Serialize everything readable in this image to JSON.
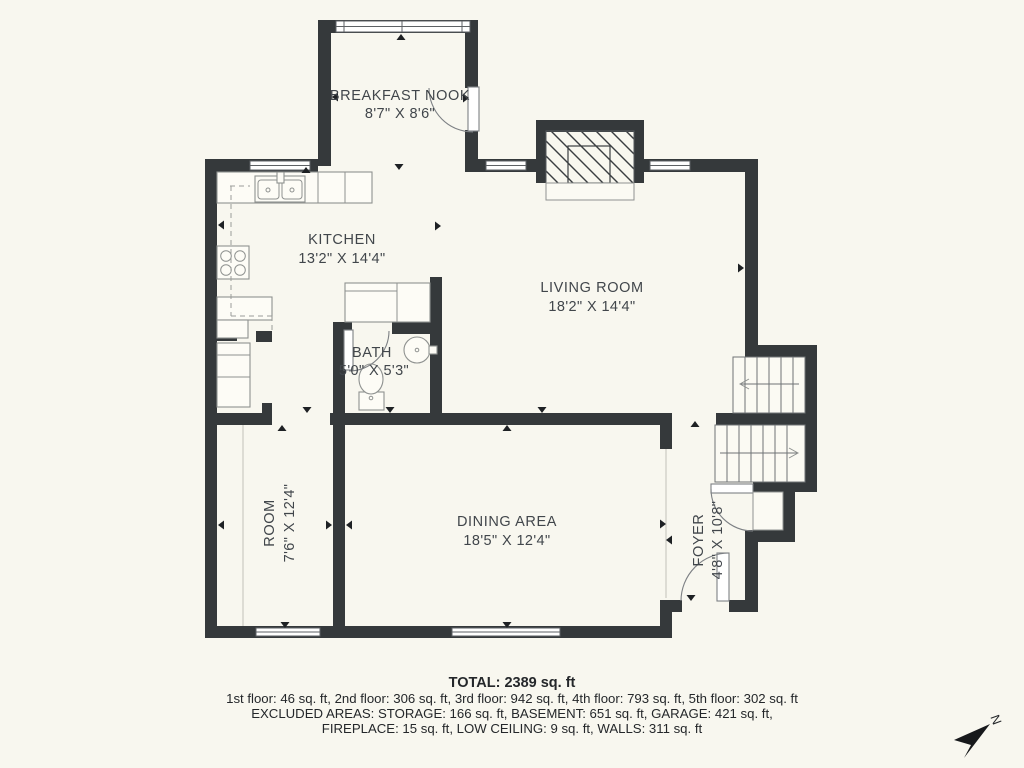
{
  "rooms": {
    "breakfast_nook": {
      "name": "BREAKFAST NOOK",
      "dims": "8'7\" X 8'6\""
    },
    "kitchen": {
      "name": "KITCHEN",
      "dims": "13'2\" X 14'4\""
    },
    "living_room": {
      "name": "LIVING ROOM",
      "dims": "18'2\" X 14'4\""
    },
    "bath": {
      "name": "BATH",
      "dims": "5'0\" X 5'3\""
    },
    "room": {
      "name": "ROOM",
      "dims": "7'6\" X 12'4\""
    },
    "dining_area": {
      "name": "DINING AREA",
      "dims": "18'5\" X 12'4\""
    },
    "foyer": {
      "name": "FOYER",
      "dims": "4'8\" X 10'8\""
    }
  },
  "summary": {
    "total": "TOTAL: 2389 sq. ft",
    "floors": "1st floor: 46 sq. ft, 2nd floor: 306 sq. ft, 3rd floor: 942 sq. ft, 4th floor: 793 sq. ft, 5th floor: 302 sq. ft",
    "excluded_1": "EXCLUDED AREAS: STORAGE: 166 sq. ft, BASEMENT: 651 sq. ft, GARAGE: 421 sq. ft,",
    "excluded_2": "FIREPLACE: 15 sq. ft, LOW CEILING: 9 sq. ft, WALLS: 311 sq. ft"
  },
  "compass": {
    "label": "N"
  },
  "colors": {
    "background": "#f8f7ef",
    "wall": "#35393b",
    "text": "#41464b"
  }
}
